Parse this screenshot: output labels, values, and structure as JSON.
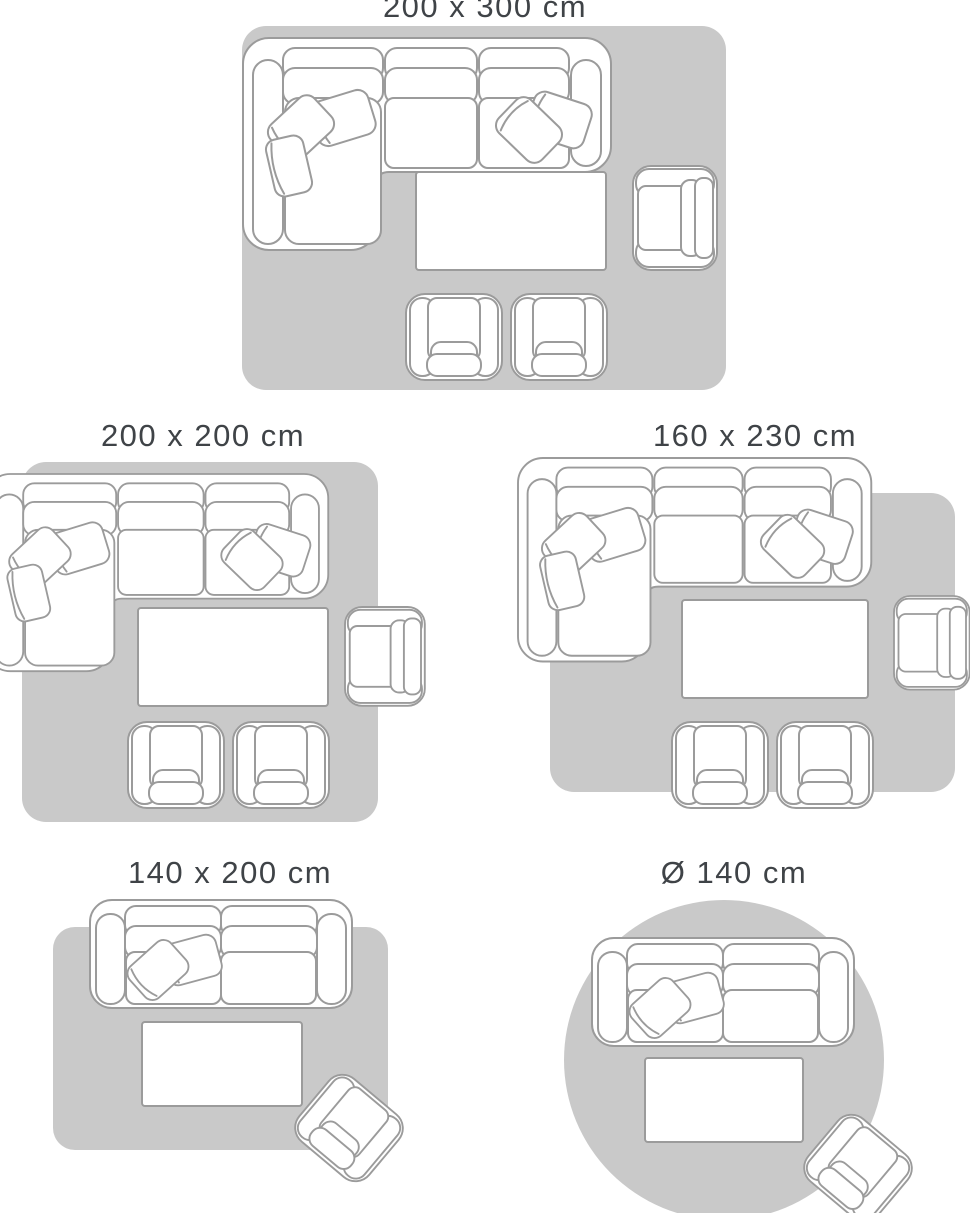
{
  "colors": {
    "background": "#ffffff",
    "rug_fill": "#c9c9c9",
    "furniture_fill": "#ffffff",
    "furniture_outline": "#9b9b9b",
    "label_text": "#3f4347"
  },
  "size_guide": {
    "diagrams": [
      {
        "label": "200 x 300 cm",
        "rug_shape": "rectangular",
        "furniture": [
          "corner-sofa-with-cushions",
          "coffee-table",
          "armchair",
          "lounge-chair",
          "lounge-chair"
        ]
      },
      {
        "label": "200 x 200 cm",
        "rug_shape": "rectangular",
        "furniture": [
          "corner-sofa-with-cushions",
          "coffee-table",
          "armchair",
          "lounge-chair",
          "lounge-chair"
        ]
      },
      {
        "label": "160 x 230 cm",
        "rug_shape": "rectangular",
        "furniture": [
          "corner-sofa-with-cushions",
          "coffee-table",
          "armchair",
          "lounge-chair",
          "lounge-chair"
        ]
      },
      {
        "label": "140 x 200 cm",
        "rug_shape": "rectangular",
        "furniture": [
          "two-seat-sofa-with-cushions",
          "coffee-table",
          "lounge-chair"
        ]
      },
      {
        "label": "Ø 140 cm",
        "rug_shape": "round",
        "furniture": [
          "two-seat-sofa-with-cushions",
          "coffee-table",
          "lounge-chair"
        ]
      }
    ]
  }
}
